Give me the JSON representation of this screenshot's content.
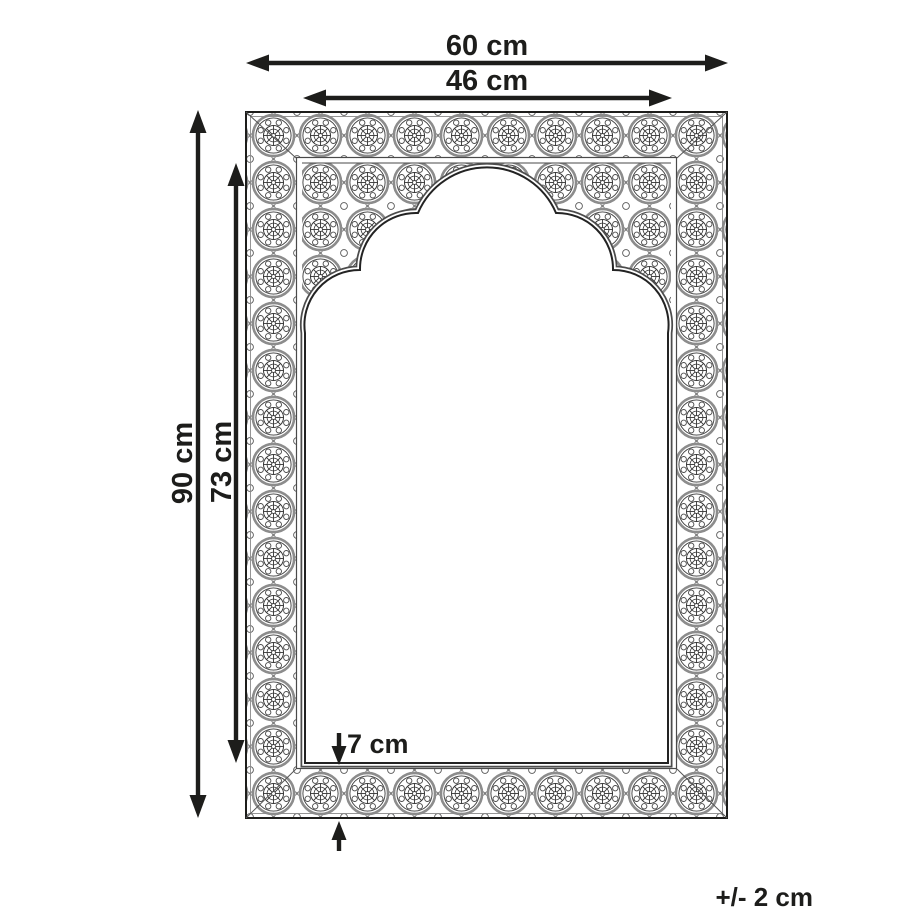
{
  "diagram": {
    "figure": "ornate-arch-mirror-dimension-diagram",
    "background_color": "#ffffff",
    "ink_color": "#1d1d1b",
    "ornament_gray": "#8c8c8c",
    "labels": {
      "outer_width": "60 cm",
      "inner_width": "46 cm",
      "outer_height": "90 cm",
      "inner_height": "73 cm",
      "frame_depth": "7 cm",
      "tolerance": "+/- 2 cm"
    }
  }
}
